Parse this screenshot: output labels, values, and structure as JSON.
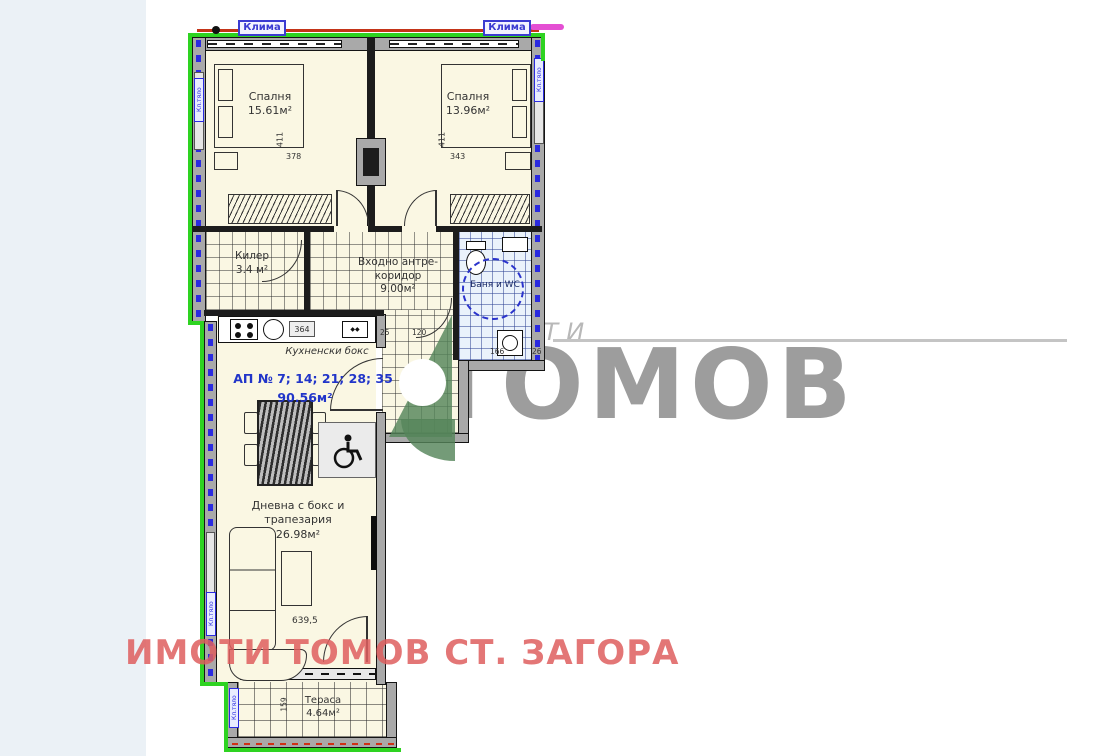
{
  "plan": {
    "klima_label": "Клима",
    "unit_label": "Кл.тяло",
    "apartment": {
      "numbers": "АП № 7; 14; 21; 28; 35",
      "total_area": "90.56м²"
    },
    "rooms": {
      "bedroom1": {
        "name": "Спалня",
        "area": "15.61м²"
      },
      "bedroom2": {
        "name": "Спалня",
        "area": "13.96м²"
      },
      "closet": {
        "name": "Килер",
        "area": "3.4 м²"
      },
      "hall": {
        "name_line1": "Входно антре-",
        "name_line2": "коридор",
        "area": "9.00м²"
      },
      "bath": {
        "name": "Баня и WC"
      },
      "kitchen": {
        "name": "Кухненски бокс"
      },
      "living": {
        "name": "Дневна с бокс и трапезария",
        "area": "26.98м²"
      },
      "terrace": {
        "name": "Тераса",
        "area": "4.64м²"
      }
    },
    "dimensions": {
      "bedroom1_width": "378",
      "bedroom1_depth": "411",
      "bedroom2_width": "343",
      "bedroom2_depth": "411",
      "kitchen_counter": "364",
      "hall_d1": "25",
      "hall_d2": "120",
      "bath_width": "166",
      "bath_d2": "26",
      "living_width": "639,5",
      "terrace_depth": "159"
    }
  },
  "watermark": {
    "small_text": "ИМОТИ",
    "large_text": "ТОМОВ",
    "footer_text": "ИМОТИ ТОМОВ СТ. ЗАГОРА",
    "colors": {
      "brand_gray": "#9d9d9d",
      "footer_red": "#df5f5f",
      "logo_green": "#55855a",
      "outline_green": "#2ed321",
      "accent_blue": "#2a2ae0"
    }
  }
}
